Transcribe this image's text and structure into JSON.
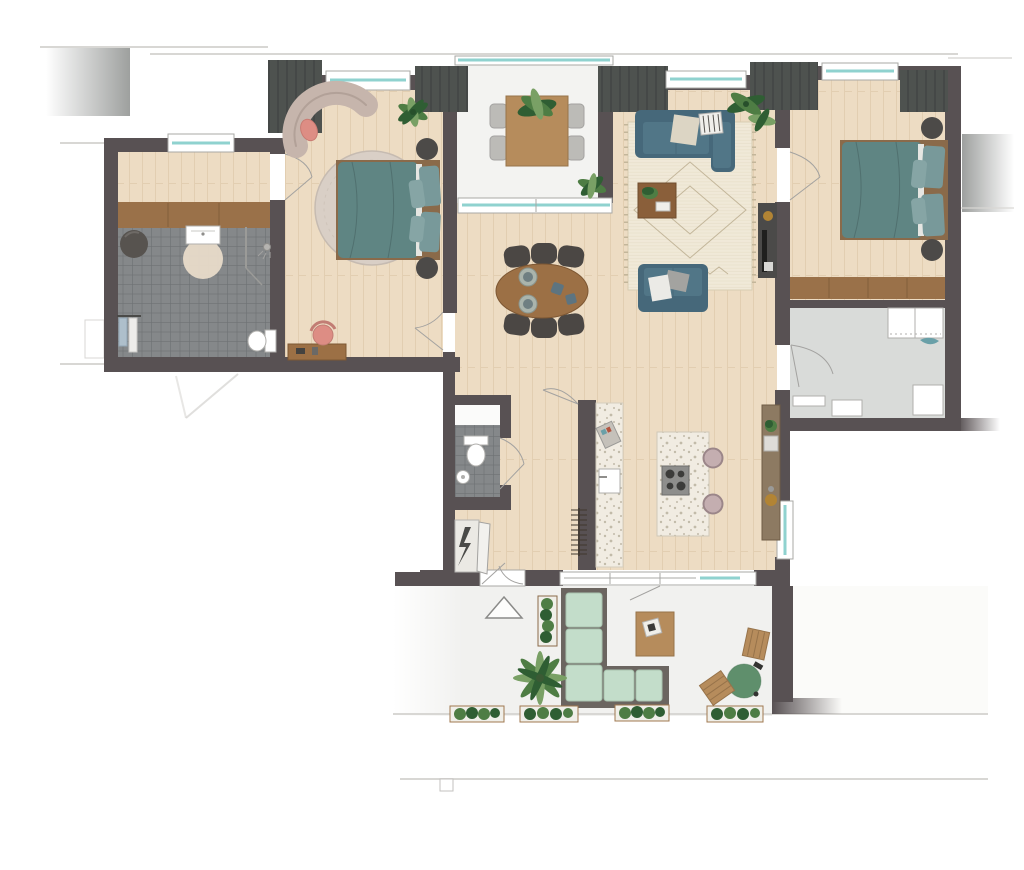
{
  "document": {
    "kind": "apartment floor plan",
    "view": "top-down furnished colour plan",
    "visible_text": "none"
  },
  "colors": {
    "wall": "#585153",
    "pier": "#4e524f",
    "pierStripe": "#424645",
    "woodFloor": "#eddcc3",
    "woodLine": "#d8c2a1",
    "woodDark": "#9a7149",
    "woodDarkLine": "#7a5634",
    "tile": "#85888a",
    "tileLine": "#6d7173",
    "balconyFloor": "#f3f3f1",
    "terraceFloor": "#f1f1ef",
    "utilityFloor": "#d9dbd9",
    "glass": "#8fd2cf",
    "contextGray": "#d8d7d4",
    "rug": "#f0e9d8",
    "rugLine": "#c3b69a",
    "roundRug": "#d9cfc6",
    "sofa": "#517687",
    "sofaDark": "#46687a",
    "bedDuvet": "#5f8583",
    "bedPillow": "#78999a",
    "bedFrame": "#8a6a4a",
    "mint": "#c3ddca",
    "mintDark": "#a8c4af",
    "outdoorFrame": "#6b6560",
    "plant": "#4e7d44",
    "plantDark": "#2f5e33",
    "plantLight": "#79a065",
    "tableWood": "#9c7045",
    "tableWoodDark": "#7d5733",
    "chairDark": "#4b4744",
    "terrazzo": "#f1ece2",
    "terrazzoDot": "#c2bba9",
    "hob": "#8e8e8c",
    "stool": "#c4aeb0",
    "pink": "#dd8d84",
    "chaise": "#c6b5ac",
    "gold": "#b28434",
    "bbq": "#5f8f6c",
    "nightstand": "#4c4a48",
    "tvUnit": "#4b4a49"
  },
  "rooms": [
    {
      "id": "entry-hall",
      "label": "Entry hall",
      "floor": "wood",
      "furniture": [
        "built-in wardrobe"
      ]
    },
    {
      "id": "bathroom",
      "label": "Bathroom",
      "floor": "dark grey tiles",
      "furniture": [
        "washbasin unit",
        "round rug",
        "walk-in shower",
        "wall-hung toilet",
        "towel rail with towels",
        "round stool"
      ]
    },
    {
      "id": "master-bedroom",
      "label": "Master bedroom",
      "floor": "wood",
      "furniture": [
        "double bed with teal bedding",
        "large round rug",
        "two round nightstands",
        "curved lounge bench with pink cushion",
        "desk with pink chair",
        "potted plant"
      ]
    },
    {
      "id": "loggia",
      "label": "Loggia balcony",
      "floor": "light pavement",
      "furniture": [
        "wooden table with plant",
        "four chairs",
        "potted plant",
        "glass balustrade"
      ]
    },
    {
      "id": "living-room",
      "label": "Living room",
      "floor": "wood",
      "furniture": [
        "teal three-seat sofa with cushions",
        "teal loveseat",
        "berber rug",
        "wooden coffee table with plant and books",
        "potted plants",
        "tv cabinet"
      ]
    },
    {
      "id": "bedroom-2",
      "label": "Bedroom 2",
      "floor": "wood",
      "furniture": [
        "double bed with teal bedding",
        "two round nightstands",
        "built-in wardrobe"
      ]
    },
    {
      "id": "utility-room",
      "label": "Utility room",
      "floor": "grey",
      "furniture": [
        "counter with shelf",
        "washer",
        "storage boxes",
        "teal cloth"
      ]
    },
    {
      "id": "kitchen-dining",
      "label": "Kitchen / dining area",
      "floor": "wood",
      "furniture": [
        "oval dining table",
        "six chairs",
        "plates and bowls",
        "kitchen island with hob",
        "two bar stools",
        "counter with sink and coffee machine",
        "tall cabinet wall",
        "radiator"
      ]
    },
    {
      "id": "toilet",
      "label": "Toilet",
      "floor": "dark grey tiles",
      "furniture": [
        "wall-hung toilet",
        "small round washbasin"
      ]
    },
    {
      "id": "tech-closet",
      "label": "Meter cupboard",
      "floor": "light",
      "furniture": [
        "electrical lightning symbol"
      ]
    }
  ],
  "outdoor": {
    "id": "terrace",
    "label": "Terrace",
    "floor": "light pavement",
    "furniture": [
      "L-shaped outdoor sofa with mint cushions",
      "wooden coffee table with tray",
      "palm plant",
      "tall planter",
      "four planter boxes with shrubs",
      "green egg barbecue",
      "two wooden slat stools",
      "entrance triangle marker"
    ]
  },
  "symbols": [
    "door-swing-arcs",
    "window-glass-teal-lines",
    "masonry-piers-striped",
    "entrance-triangle",
    "lightning-bolt-electrical",
    "shower-head",
    "radiator-fins"
  ]
}
